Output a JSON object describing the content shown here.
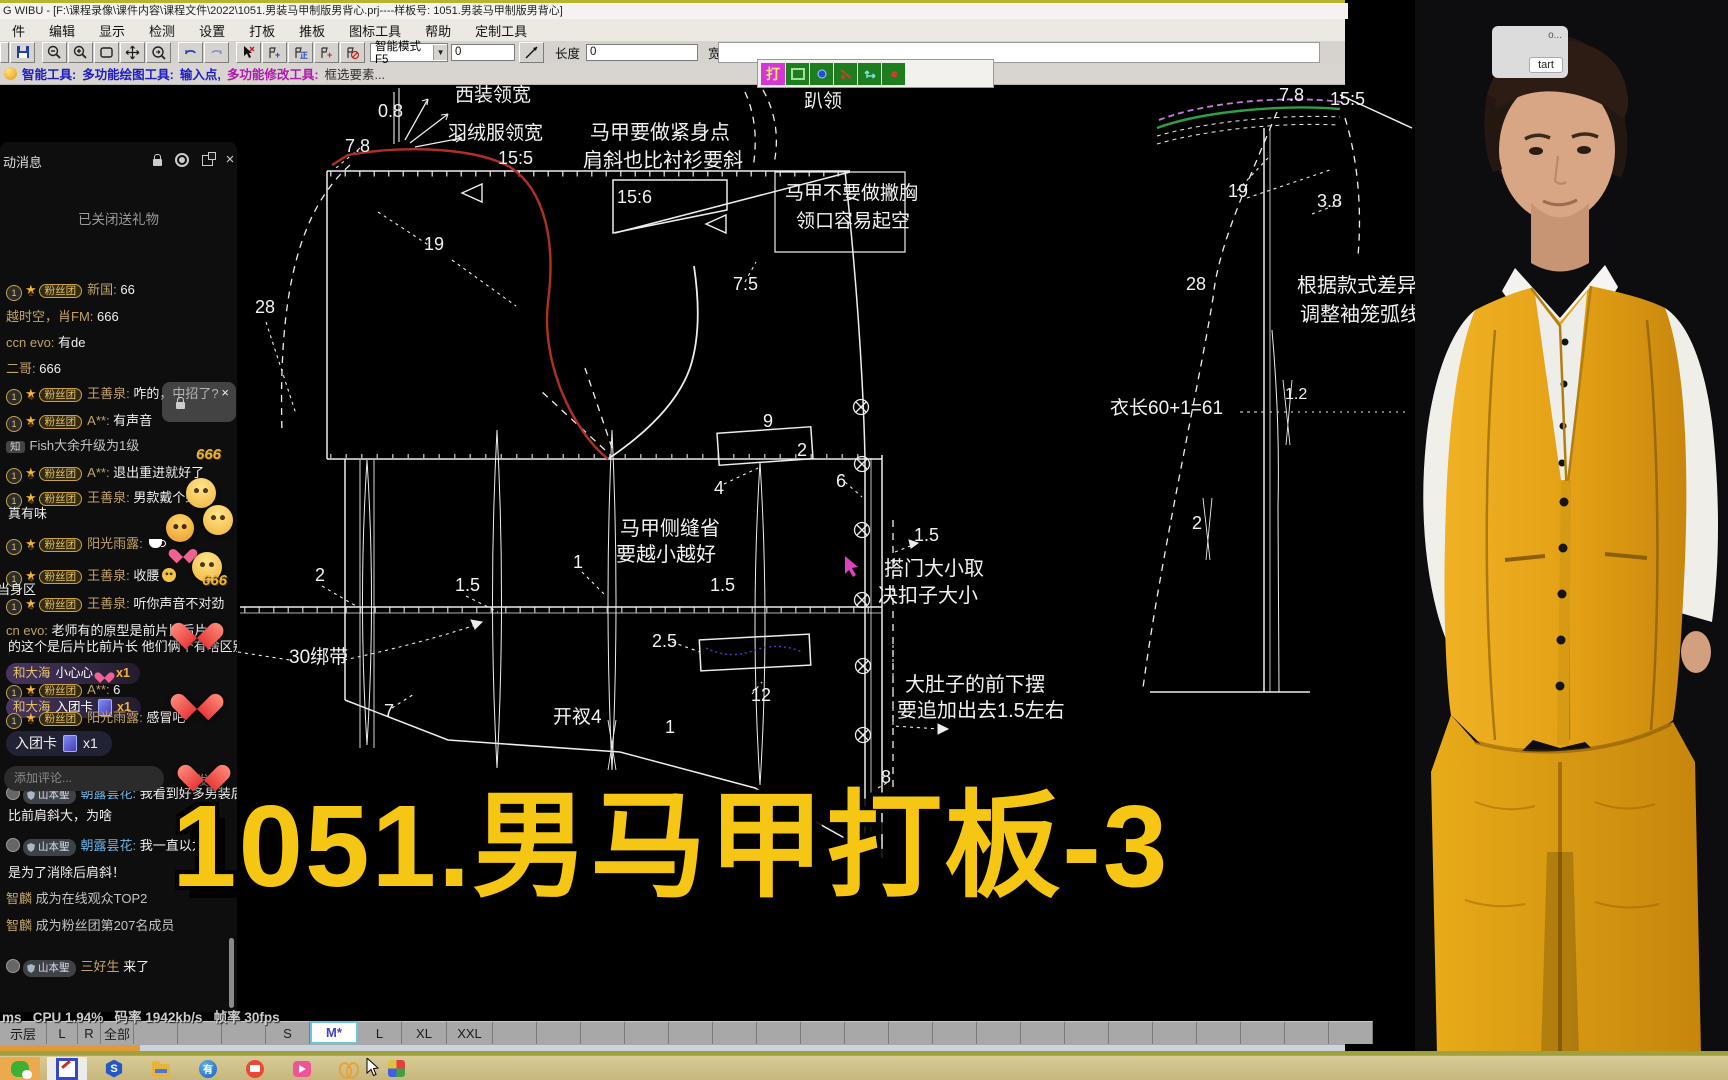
{
  "window": {
    "title": "G WIBU - [F:\\课程录像\\课件内容\\课程文件\\2022\\1051.男装马甲制版男背心.prj----样板号: 1051.男装马甲制版男背心]"
  },
  "menu": {
    "items": [
      "件",
      "编辑",
      "显示",
      "检测",
      "设置",
      "打板",
      "推板",
      "图标工具",
      "帮助",
      "定制工具"
    ]
  },
  "toolbar": {
    "mode": "智能模式F5",
    "val1": "0",
    "len_label": "长度",
    "len_value": "0",
    "wid_label": "宽度",
    "wid_value": "0",
    "mini_label": "打"
  },
  "prompt": {
    "p1": "智能工具:",
    "p2": "多功能绘图工具:",
    "p3": "输入点,",
    "p4": "多功能修改工具:",
    "p5": "框选要素..."
  },
  "overlay": {
    "big_title": "1051.男马甲打板-3"
  },
  "stats": {
    "text": "ms   CPU 1.94%   码率 1942kb/s   帧率 30fps"
  },
  "capture": {
    "mini_text": "o...",
    "button": "tart"
  },
  "size_bar": {
    "cells": [
      "示层",
      "L",
      "R",
      "全部",
      "",
      "",
      "",
      "S",
      "M*",
      "L",
      "XL",
      "XXL"
    ],
    "widths": [
      46,
      30,
      22,
      32,
      43,
      43,
      43,
      43,
      44,
      43,
      44,
      45
    ],
    "active": "M*",
    "filler_count": 20,
    "filler_width": 43
  },
  "taskbar": {
    "icons": [
      "wechat-icon",
      "paint-app-icon",
      "s-hexagon-icon",
      "file-explorer-icon",
      "youdao-icon",
      "recorder-icon",
      "video-camera-icon",
      "butterfly-icon",
      "pinwheel-icon"
    ]
  },
  "chat": {
    "header": "动消息",
    "labels": {
      "fan": "粉丝团",
      "guard": "山本聖"
    },
    "input_placeholder": "添加评论...",
    "send": "发送",
    "rows": [
      {
        "k": "center",
        "y": 224,
        "t": "已关闭送礼物"
      },
      {
        "k": "m",
        "y": 294,
        "lv": "2",
        "n": "新国",
        "t": "66"
      },
      {
        "k": "p",
        "y": 321,
        "n": "越时空，肖FM",
        "t": "666"
      },
      {
        "k": "p",
        "y": 347,
        "n": "ccn evo",
        "t": "有de"
      },
      {
        "k": "p",
        "y": 373,
        "n": "二哥",
        "t": "666"
      },
      {
        "k": "m",
        "y": 398,
        "lv": "4",
        "n": "王善泉",
        "t": "咋的，中招了?"
      },
      {
        "k": "m",
        "y": 425,
        "lv": "5",
        "n": "A**",
        "t": "有声音"
      },
      {
        "k": "n",
        "y": 450,
        "b": "知",
        "t": "Fish大余升级为1级"
      },
      {
        "k": "m",
        "y": 477,
        "lv": "5",
        "n": "A**",
        "t": "退出重进就好了"
      },
      {
        "k": "m",
        "y": 502,
        "lv": "4",
        "n": "王善泉",
        "t": "男款戴个蝴蝶"
      },
      {
        "k": "c",
        "y": 518,
        "t": "真有味"
      },
      {
        "k": "m",
        "y": 548,
        "lv": "5",
        "n": "阳光雨露",
        "t": "",
        "icon": "coffee"
      },
      {
        "k": "m",
        "y": 580,
        "lv": "4",
        "n": "王善泉",
        "t": "收腰",
        "icon": "face"
      },
      {
        "k": "cut",
        "y": 594,
        "t": "当身区"
      },
      {
        "k": "m",
        "y": 608,
        "lv": "4",
        "n": "王善泉",
        "t": "听你声音不对劲"
      },
      {
        "k": "p",
        "y": 635,
        "n": "cn evo",
        "t": "老师有的原型是前片比后片"
      },
      {
        "k": "c",
        "y": 651,
        "t": "的这个是后片比前片长 他们俩个有啥区别"
      },
      {
        "k": "g",
        "y": 676,
        "n": "和大海",
        "t": "小心心",
        "icon": "heart",
        "x": "x1"
      },
      {
        "k": "m",
        "y": 694,
        "lv": "5",
        "n": "A**",
        "t": "6"
      },
      {
        "k": "g",
        "y": 710,
        "n": "和大海",
        "t": "入团卡",
        "icon": "card",
        "x": "x1"
      },
      {
        "k": "m",
        "y": 722,
        "lv": "5",
        "n": "阳光雨露",
        "t": "感冒吧"
      },
      {
        "k": "g2",
        "y": 744,
        "t": "入团卡",
        "icon": "card",
        "x": "x1"
      },
      {
        "k": "gd",
        "y": 798,
        "n": "朝露昙花",
        "nc": "blue",
        "t": "我看到好多男装后"
      },
      {
        "k": "c",
        "y": 820,
        "t": "比前肩斜大，为啥"
      },
      {
        "k": "gd",
        "y": 850,
        "n": "朝露昙花",
        "nc": "blue",
        "t": "我一直以为后"
      },
      {
        "k": "c",
        "y": 877,
        "t": "是为了消除后肩斜！"
      },
      {
        "k": "s",
        "y": 903,
        "n": "智麟",
        "t": "成为在线观众TOP2"
      },
      {
        "k": "s",
        "y": 930,
        "n": "智麟",
        "t": "成为粉丝团第207名成员"
      },
      {
        "k": "gd",
        "y": 971,
        "n": "三好生",
        "col": false,
        "t": "来了"
      }
    ],
    "floaters": [
      {
        "c": "fl-six",
        "x": 196,
        "y": 446,
        "t": "666"
      },
      {
        "c": "fl-face",
        "x": 186,
        "y": 478
      },
      {
        "c": "fl-face",
        "x": 203,
        "y": 505
      },
      {
        "c": "fl-angry",
        "x": 166,
        "y": 514
      },
      {
        "c": "fl-heart-sm",
        "x": 174,
        "y": 543
      },
      {
        "c": "fl-face",
        "x": 192,
        "y": 552
      },
      {
        "c": "fl-six",
        "x": 202,
        "y": 572,
        "t": "666"
      },
      {
        "c": "fl-heart",
        "x": 181,
        "y": 596
      },
      {
        "c": "fl-heart",
        "x": 181,
        "y": 638
      },
      {
        "c": "fl-heart",
        "x": 188,
        "y": 680
      }
    ]
  },
  "pattern": {
    "colors": {
      "line": "#ededed",
      "red_curve": "#b03028",
      "green_curve": "#2f9e44",
      "purple_dash": "#c77dde",
      "blue_dots": "#4444c0",
      "cursor": "#e040c0"
    },
    "annotations": [
      {
        "x": 378,
        "y": 117,
        "t": "0.8",
        "s": 18
      },
      {
        "x": 455,
        "y": 101,
        "t": "西装领宽",
        "s": 19
      },
      {
        "x": 448,
        "y": 139,
        "t": "羽绒服领宽",
        "s": 19
      },
      {
        "x": 345,
        "y": 152,
        "t": "7.8",
        "s": 18
      },
      {
        "x": 498,
        "y": 164,
        "t": "15:5",
        "s": 18
      },
      {
        "x": 590,
        "y": 139,
        "t": "马甲要做紧身点",
        "s": 20
      },
      {
        "x": 583,
        "y": 167,
        "t": "肩斜也比衬衫要斜",
        "s": 20
      },
      {
        "x": 617,
        "y": 203,
        "t": "15:6",
        "s": 18
      },
      {
        "x": 804,
        "y": 107,
        "t": "趴领",
        "s": 19
      },
      {
        "x": 785,
        "y": 199,
        "t": "马甲不要做撇胸",
        "s": 19
      },
      {
        "x": 796,
        "y": 227,
        "t": "领口容易起空",
        "s": 19
      },
      {
        "x": 424,
        "y": 250,
        "t": "19",
        "s": 18
      },
      {
        "x": 733,
        "y": 290,
        "t": "7.5",
        "s": 18
      },
      {
        "x": 255,
        "y": 313,
        "t": "28",
        "s": 18
      },
      {
        "x": 763,
        "y": 427,
        "t": "9",
        "s": 18
      },
      {
        "x": 797,
        "y": 456,
        "t": "2",
        "s": 18
      },
      {
        "x": 714,
        "y": 494,
        "t": "4",
        "s": 18
      },
      {
        "x": 836,
        "y": 487,
        "t": "6",
        "s": 18
      },
      {
        "x": 620,
        "y": 535,
        "t": "马甲侧缝省",
        "s": 20
      },
      {
        "x": 616,
        "y": 561,
        "t": "要越小越好",
        "s": 20
      },
      {
        "x": 573,
        "y": 568,
        "t": "1",
        "s": 18
      },
      {
        "x": 914,
        "y": 541,
        "t": "1.5",
        "s": 18
      },
      {
        "x": 884,
        "y": 575,
        "t": "搭门大小取",
        "s": 20
      },
      {
        "x": 878,
        "y": 602,
        "t": "决扣子大小",
        "s": 20
      },
      {
        "x": 315,
        "y": 581,
        "t": "2",
        "s": 18
      },
      {
        "x": 455,
        "y": 591,
        "t": "1.5",
        "s": 18
      },
      {
        "x": 710,
        "y": 591,
        "t": "1.5",
        "s": 18
      },
      {
        "x": 652,
        "y": 647,
        "t": "2.5",
        "s": 18
      },
      {
        "x": 289,
        "y": 663,
        "t": "30绑带",
        "s": 19
      },
      {
        "x": 751,
        "y": 701,
        "t": "12",
        "s": 18
      },
      {
        "x": 905,
        "y": 691,
        "t": "大肚子的前下摆",
        "s": 20
      },
      {
        "x": 897,
        "y": 717,
        "t": "要追加出去1.5左右",
        "s": 20
      },
      {
        "x": 553,
        "y": 723,
        "t": "开衩4",
        "s": 19
      },
      {
        "x": 384,
        "y": 717,
        "t": "7",
        "s": 18
      },
      {
        "x": 665,
        "y": 733,
        "t": "1",
        "s": 18
      },
      {
        "x": 881,
        "y": 783,
        "t": "8",
        "s": 18
      },
      {
        "x": 1279,
        "y": 101,
        "t": "7.8",
        "s": 18
      },
      {
        "x": 1330,
        "y": 105,
        "t": "15:5",
        "s": 18
      },
      {
        "x": 1228,
        "y": 197,
        "t": "19",
        "s": 18
      },
      {
        "x": 1317,
        "y": 207,
        "t": "3.8",
        "s": 18
      },
      {
        "x": 1186,
        "y": 290,
        "t": "28",
        "s": 18
      },
      {
        "x": 1297,
        "y": 292,
        "t": "根据款式差异",
        "s": 20
      },
      {
        "x": 1300,
        "y": 321,
        "t": "调整袖笼弧线",
        "s": 20
      },
      {
        "x": 1110,
        "y": 414,
        "t": "衣长60+1=61",
        "s": 19
      },
      {
        "x": 1285,
        "y": 399,
        "t": "1.2",
        "s": 16
      },
      {
        "x": 1192,
        "y": 529,
        "t": "2",
        "s": 18
      }
    ],
    "buttons": [
      {
        "x": 861,
        "y": 407
      },
      {
        "x": 862,
        "y": 464
      },
      {
        "x": 862,
        "y": 530
      },
      {
        "x": 862,
        "y": 600
      },
      {
        "x": 863,
        "y": 666
      },
      {
        "x": 863,
        "y": 735
      }
    ]
  }
}
